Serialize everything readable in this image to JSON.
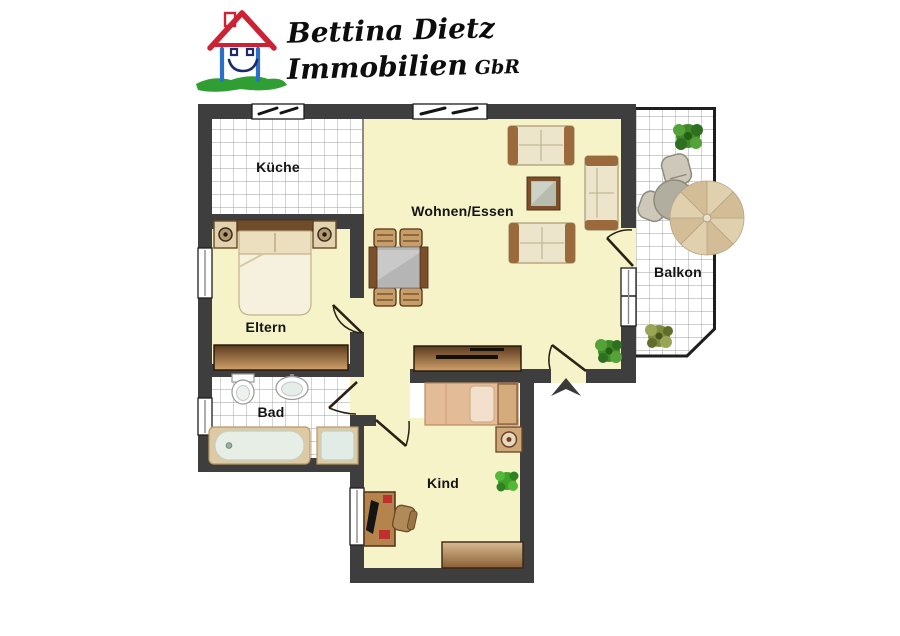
{
  "logo": {
    "company_line1": "Bettina Dietz",
    "company_line2": "Immobilien",
    "company_suffix": "GbR"
  },
  "rooms": {
    "kueche": {
      "label": "Küche"
    },
    "wohnen": {
      "label": "Wohnen/Essen"
    },
    "balkon": {
      "label": "Balkon"
    },
    "eltern": {
      "label": "Eltern"
    },
    "bad": {
      "label": "Bad"
    },
    "kind": {
      "label": "Kind"
    }
  },
  "icons": {
    "entrance_arrow": "arrow-up-entrance",
    "plants": [
      "plant-living",
      "plant-balcony-top",
      "plant-balcony-bottom",
      "plant-kind"
    ],
    "umbrella": "parasol-balcony"
  },
  "colors": {
    "wall": "#3e3e3e",
    "floor_yellow": "#f6f3c9",
    "floor_tile": "#ffffff",
    "tile_line": "#9f9f9f",
    "wood_dark": "#5a3a1e",
    "wood_light": "#cfa06a",
    "logo_roof_red": "#cc2233",
    "logo_wall_blue": "#2a6fc9",
    "logo_grass_green": "#2f9e33",
    "label_text": "#141414"
  }
}
